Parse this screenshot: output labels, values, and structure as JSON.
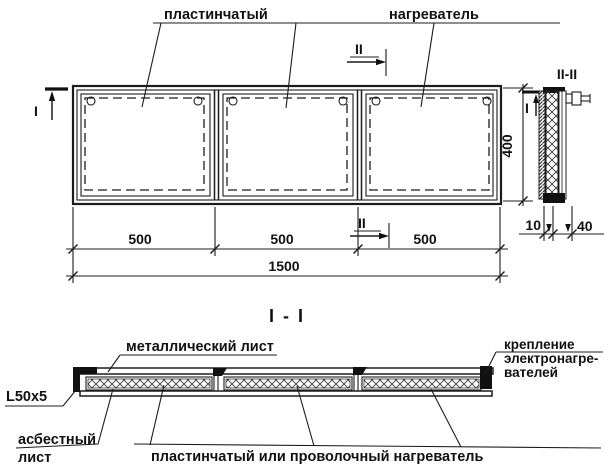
{
  "drawing": {
    "background": "#ffffff",
    "ink": "#1c1c1c",
    "top_labels": {
      "plate": "пластинчатый",
      "heater": "нагреватель"
    },
    "plan_view": {
      "marker_i": "I",
      "marker_ii_top": "II",
      "marker_ii_bottom": "II",
      "dim_height": "400",
      "dim_segments": [
        "500",
        "500",
        "500"
      ],
      "dim_total": "1500"
    },
    "section_ii": {
      "title": "II-II",
      "marker_i": "I",
      "dim_left": "10",
      "dim_right": "40"
    },
    "section_i": {
      "title": "I - I",
      "label_metal_sheet": "металлический лист",
      "label_angle": "L50x5",
      "label_asbestos_line1": "асбестный",
      "label_asbestos_line2": "лист",
      "label_heater": "пластинчатый или проволочный нагреватель",
      "label_mount_line1": "крепление",
      "label_mount_line2": "электронагре-",
      "label_mount_line3": "вателей"
    }
  }
}
